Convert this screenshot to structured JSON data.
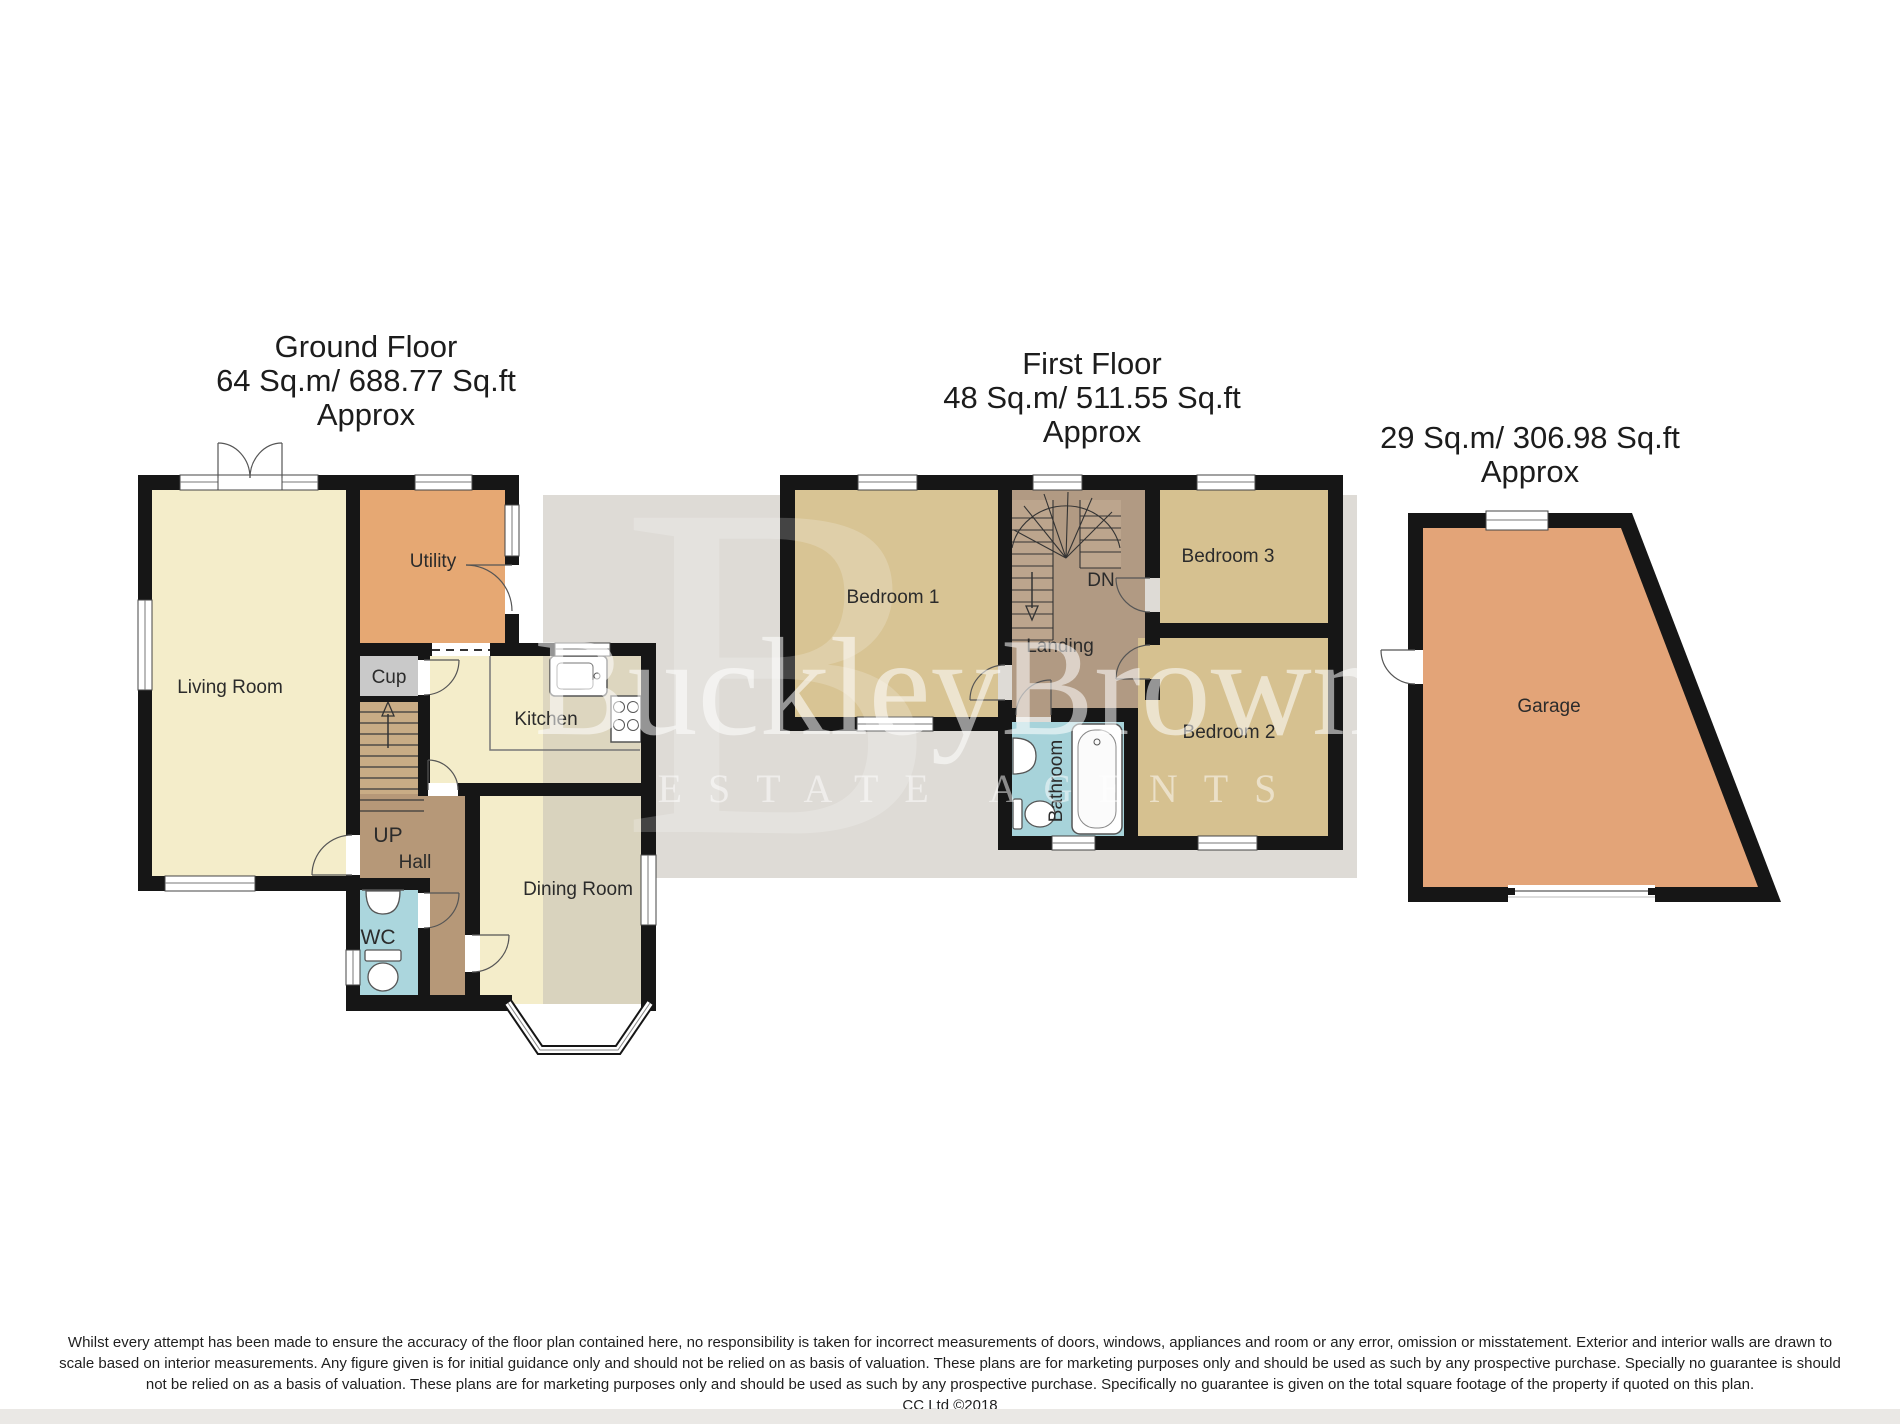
{
  "titles": {
    "ground": [
      "Ground Floor",
      "64 Sq.m/ 688.77 Sq.ft",
      "Approx"
    ],
    "first": [
      "First Floor",
      "48 Sq.m/ 511.55 Sq.ft",
      "Approx"
    ],
    "garage": [
      "29 Sq.m/ 306.98 Sq.ft",
      "Approx"
    ]
  },
  "rooms": {
    "living_room": "Living Room",
    "utility": "Utility",
    "cup": "Cup",
    "kitchen": "Kitchen",
    "up": "UP",
    "hall": "Hall",
    "wc": "WC",
    "dining_room": "Dining Room",
    "bedroom1": "Bedroom 1",
    "dn": "DN",
    "landing": "Landing",
    "bedroom3": "Bedroom 3",
    "bedroom2": "Bedroom 2",
    "bathroom": "Bathroom",
    "garage": "Garage"
  },
  "watermark": {
    "brand": "BuckleyBrown",
    "tagline": "ESTATE AGENTS",
    "monogram": "B"
  },
  "footer": [
    "Whilst every attempt has been made to ensure the accuracy of the floor plan contained here, no responsibility is taken for incorrect measurements of doors, windows, appliances and room or any error, omission or misstatement. Exterior and interior walls are drawn to",
    "scale based on interior measurements. Any figure given is for initial guidance only and should not be relied on as basis of valuation. These plans are for marketing purposes only and should be used as such by any prospective purchase. Specially no guarantee is should",
    "not be relied on as a basis of valuation. These plans are for marketing purposes only and should be used as such by any prospective purchase. Specifically no guarantee is given on the total square footage of the property if quoted on this plan.",
    "CC Ltd ©2018"
  ],
  "colors": {
    "wall": "#161616",
    "cream_room": "#f4edca",
    "utility_orange": "#e6a873",
    "garage_orange": "#e3a478",
    "bedroom_tan": "#d6c190",
    "hall_brown": "#b69878",
    "landing_brown": "#b19a83",
    "bathroom_blue": "#a7d3da",
    "cupboard_gray": "#c9c9c9",
    "backdrop_gray": "#dedbd6",
    "stairs_tan": "#c9ac85"
  }
}
